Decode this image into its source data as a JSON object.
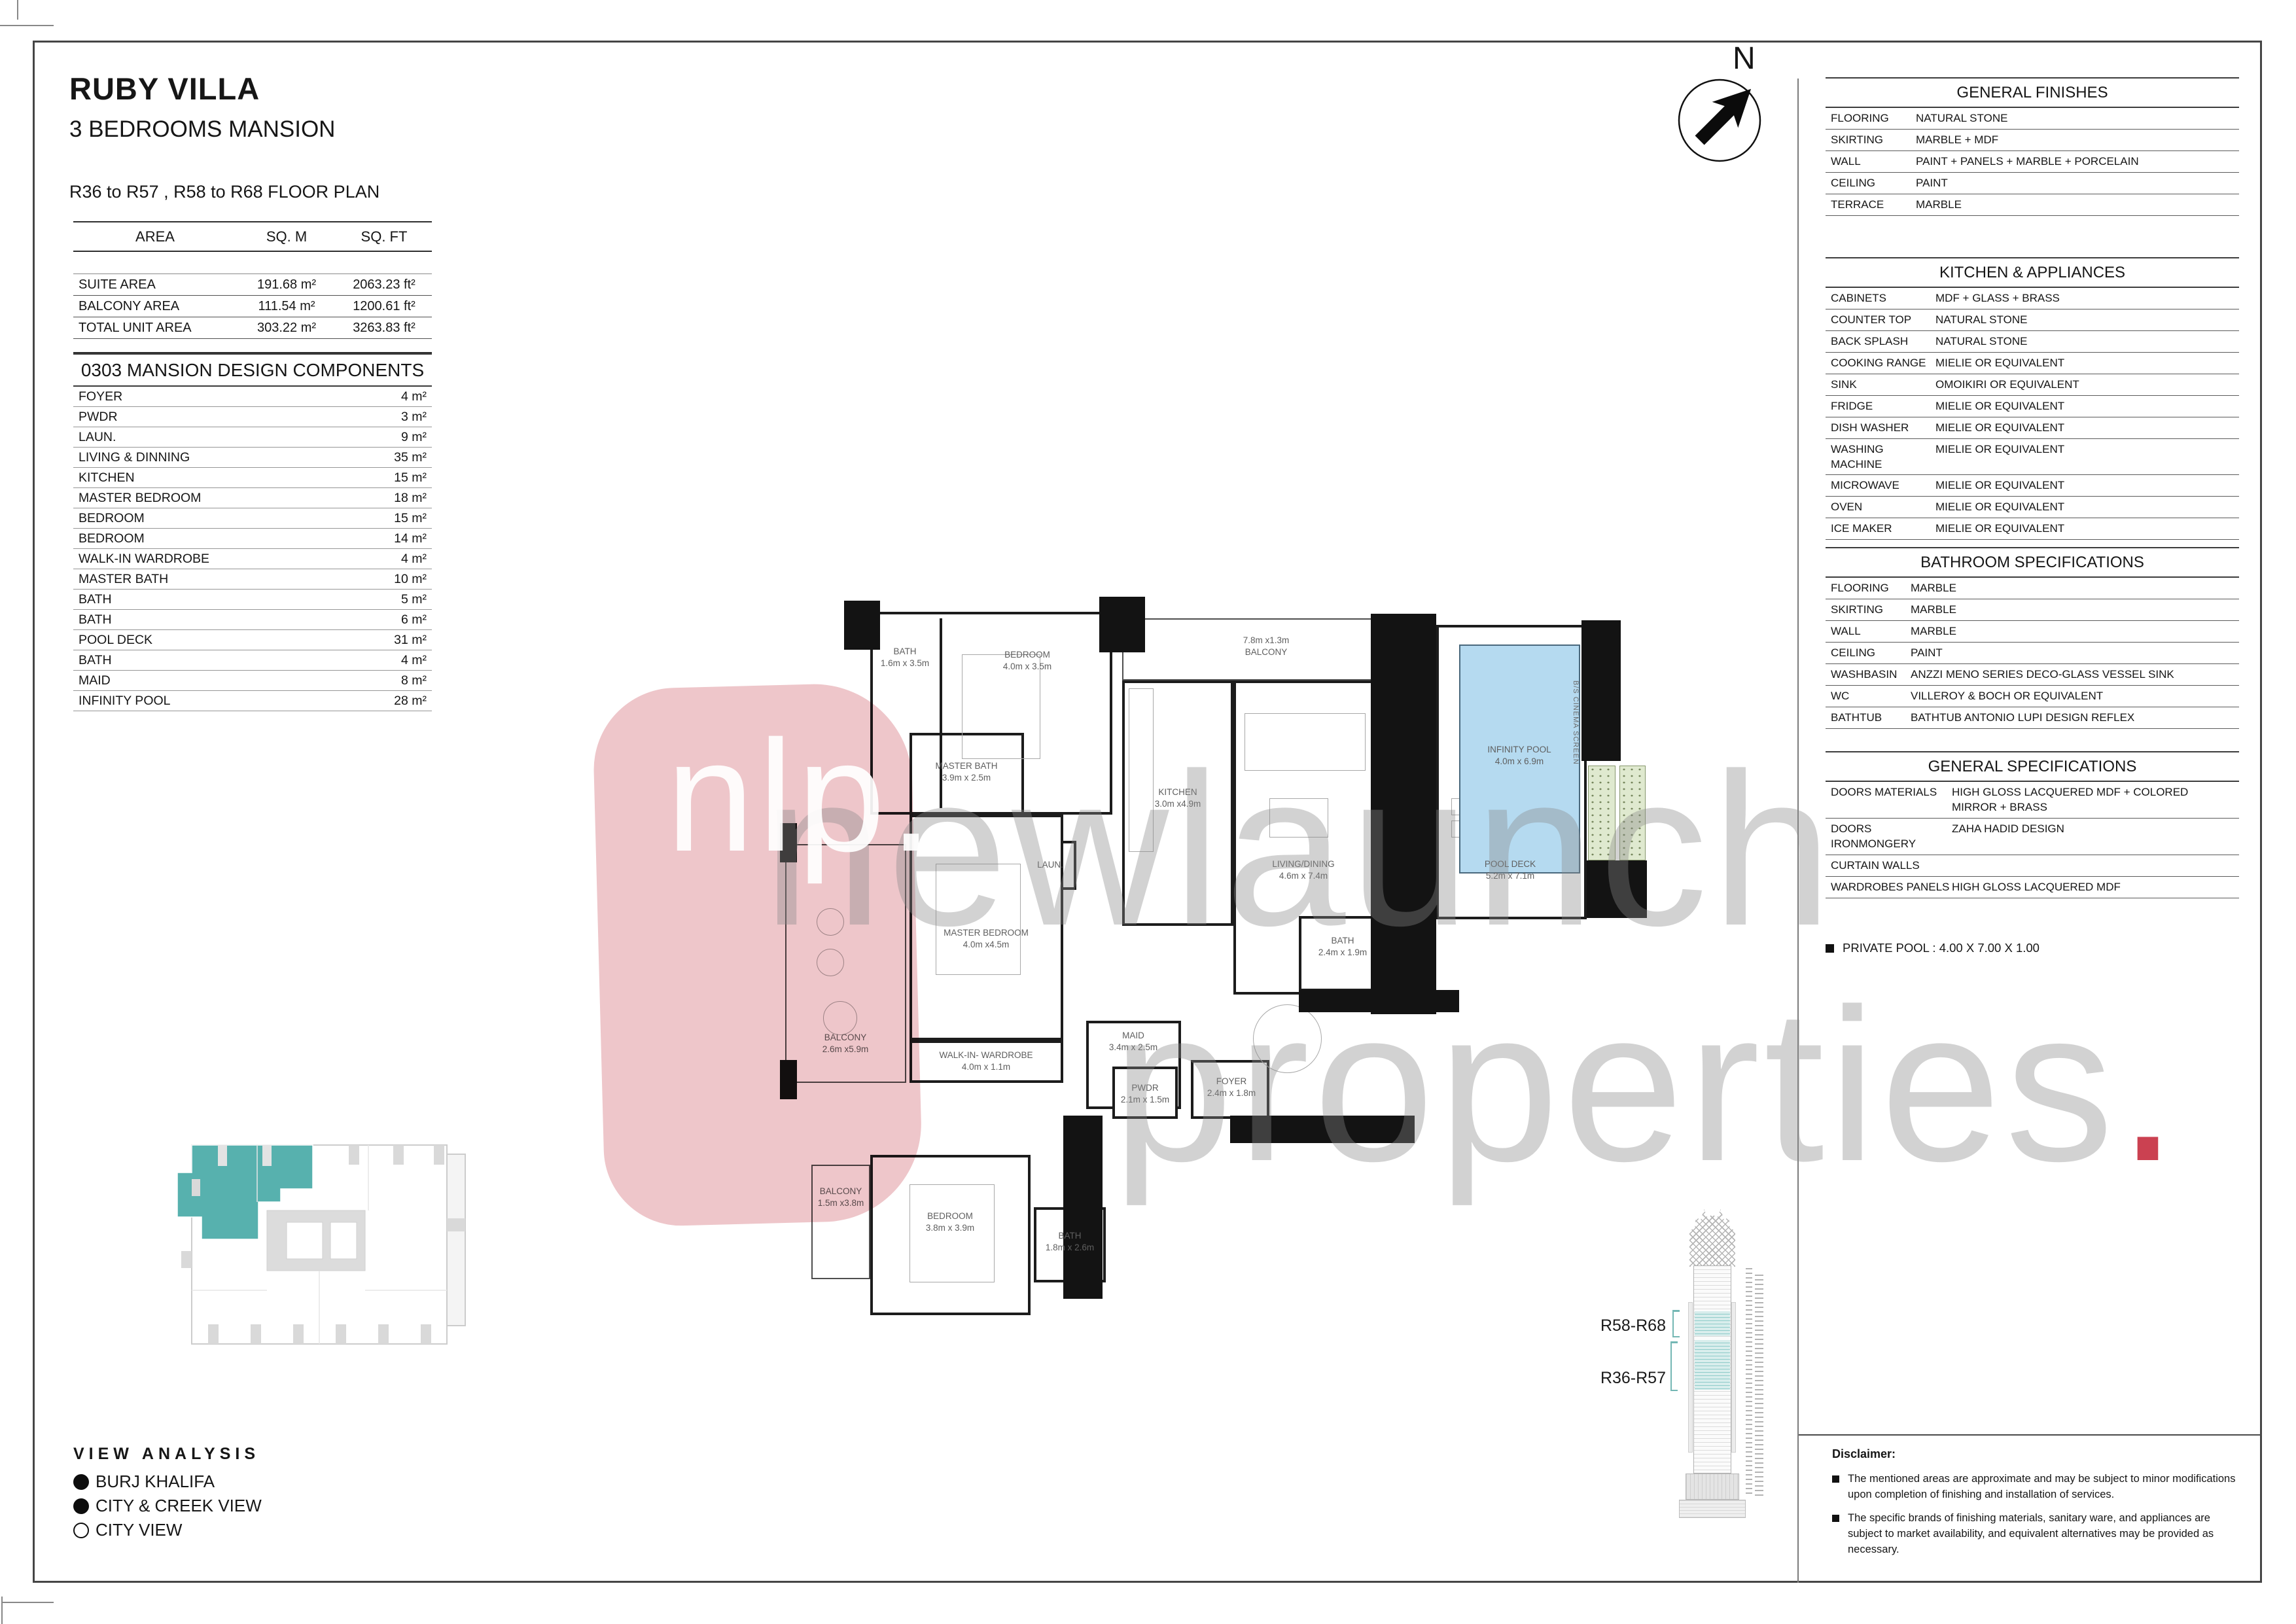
{
  "header": {
    "title": "RUBY VILLA",
    "subtitle": "3 BEDROOMS MANSION",
    "floor_line": "R36 to R57 , R58 to R68 FLOOR PLAN"
  },
  "compass": {
    "label": "N",
    "icon": "north-arrow-icon"
  },
  "area_table": {
    "headers": [
      "AREA",
      "SQ. M",
      "SQ. FT"
    ],
    "rows": [
      [
        "SUITE AREA",
        "191.68 m²",
        "2063.23 ft²"
      ],
      [
        "BALCONY AREA",
        "111.54 m²",
        "1200.61 ft²"
      ],
      [
        "TOTAL UNIT AREA",
        "303.22 m²",
        "3263.83 ft²"
      ]
    ]
  },
  "components": {
    "title": "0303 MANSION DESIGN COMPONENTS",
    "rows": [
      [
        "FOYER",
        "4 m²"
      ],
      [
        "PWDR",
        "3 m²"
      ],
      [
        "LAUN.",
        "9 m²"
      ],
      [
        "LIVING & DINNING",
        "35 m²"
      ],
      [
        "KITCHEN",
        "15 m²"
      ],
      [
        "MASTER BEDROOM",
        "18 m²"
      ],
      [
        "BEDROOM",
        "15 m²"
      ],
      [
        "BEDROOM",
        "14 m²"
      ],
      [
        "WALK-IN WARDROBE",
        "4 m²"
      ],
      [
        "MASTER BATH",
        "10 m²"
      ],
      [
        "BATH",
        "5 m²"
      ],
      [
        "BATH",
        "6 m²"
      ],
      [
        "POOL DECK",
        "31 m²"
      ],
      [
        "BATH",
        "4 m²"
      ],
      [
        "MAID",
        "8 m²"
      ],
      [
        "INFINITY POOL",
        "28 m²"
      ]
    ]
  },
  "specs": {
    "general_finishes": {
      "title": "GENERAL FINISHES",
      "rows": [
        [
          "FLOORING",
          "NATURAL STONE"
        ],
        [
          "SKIRTING",
          "MARBLE + MDF"
        ],
        [
          "WALL",
          "PAINT + PANELS + MARBLE + PORCELAIN"
        ],
        [
          "CEILING",
          "PAINT"
        ],
        [
          "TERRACE",
          "MARBLE"
        ]
      ]
    },
    "kitchen": {
      "title": "KITCHEN & APPLIANCES",
      "rows": [
        [
          "CABINETS",
          "MDF + GLASS + BRASS"
        ],
        [
          "COUNTER TOP",
          "NATURAL STONE"
        ],
        [
          "BACK SPLASH",
          "NATURAL STONE"
        ],
        [
          "COOKING RANGE",
          "MIELIE OR EQUIVALENT"
        ],
        [
          "SINK",
          "OMOIKIRI OR EQUIVALENT"
        ],
        [
          "FRIDGE",
          "MIELIE OR EQUIVALENT"
        ],
        [
          "DISH WASHER",
          "MIELIE OR EQUIVALENT"
        ],
        [
          "WASHING MACHINE",
          "MIELIE OR EQUIVALENT"
        ],
        [
          "MICROWAVE",
          "MIELIE OR EQUIVALENT"
        ],
        [
          "OVEN",
          "MIELIE OR EQUIVALENT"
        ],
        [
          "ICE MAKER",
          "MIELIE OR EQUIVALENT"
        ]
      ]
    },
    "bathroom": {
      "title": "BATHROOM SPECIFICATIONS",
      "rows": [
        [
          "FLOORING",
          "MARBLE"
        ],
        [
          "SKIRTING",
          "MARBLE"
        ],
        [
          "WALL",
          "MARBLE"
        ],
        [
          "CEILING",
          "PAINT"
        ],
        [
          "WASHBASIN",
          "ANZZI  MENO SERIES DECO-GLASS VESSEL SINK"
        ],
        [
          "WC",
          "VILLEROY & BOCH OR EQUIVALENT"
        ],
        [
          "BATHTUB",
          "BATHTUB ANTONIO LUPI DESIGN REFLEX"
        ]
      ]
    },
    "general_specs": {
      "title": "GENERAL SPECIFICATIONS",
      "rows": [
        [
          "DOORS MATERIALS",
          "HIGH GLOSS LACQUERED MDF + COLORED MIRROR + BRASS"
        ],
        [
          "DOORS IRONMONGERY",
          "ZAHA HADID DESIGN"
        ],
        [
          "CURTAIN WALLS",
          ""
        ],
        [
          "WARDROBES PANELS",
          "HIGH GLOSS LACQUERED MDF"
        ]
      ]
    }
  },
  "private_pool_note": "PRIVATE POOL :  4.00 X 7.00 X 1.00",
  "disclaimer": {
    "title": "Disclaimer:",
    "items": [
      "The mentioned areas are approximate and may be subject to minor modifications  upon completion of finishing and installation of services.",
      "The specific brands of finishing materials, sanitary ware, and appliances are subject to market availability, and equivalent alternatives may be provided as necessary."
    ]
  },
  "view_analysis": {
    "title": "VIEW ANALYSIS",
    "items": [
      {
        "label": "BURJ KHALIFA",
        "filled": true
      },
      {
        "label": "CITY & CREEK VIEW",
        "filled": true
      },
      {
        "label": "CITY VIEW",
        "filled": false
      }
    ]
  },
  "tower": {
    "upper_label": "R58-R68",
    "lower_label": "R36-R57"
  },
  "watermark": {
    "logo": "nlp.",
    "line1": "newlaunch",
    "line2": "properties",
    "dot": ".",
    "accent_color": "#c22033",
    "pink_color": "#eec6ca"
  },
  "plan": {
    "rooms": {
      "bath_top": {
        "name": "BATH",
        "dims": "1.6m x 3.5m"
      },
      "bedroom_top": {
        "name": "BEDROOM",
        "dims": "4.0m x 3.5m"
      },
      "balcony_top": {
        "name": "BALCONY",
        "dims": "7.8m x1.3m"
      },
      "kitchen": {
        "name": "KITCHEN",
        "dims": "3.0m x4.9m"
      },
      "living": {
        "name": "LIVING/DINING",
        "dims": "4.6m x 7.4m"
      },
      "pool_deck": {
        "name": "POOL DECK",
        "dims": "5.2m x 7.1m"
      },
      "infinity_pool": {
        "name": "INFINITY POOL",
        "dims": "4.0m x 6.9m"
      },
      "cinema_screen": {
        "name": "B/S CINEMA SCREEN"
      },
      "master_bath": {
        "name": "MASTER BATH",
        "dims": "3.9m x 2.5m"
      },
      "laundry": {
        "name": "LAUN."
      },
      "balcony_left": {
        "name": "BALCONY",
        "dims": "2.6m x5.9m"
      },
      "master_bedroom": {
        "name": "MASTER BEDROOM",
        "dims": "4.0m x4.5m"
      },
      "maid": {
        "name": "MAID",
        "dims": "3.4m x 2.5m"
      },
      "pwdr": {
        "name": "PWDR",
        "dims": "2.1m x 1.5m"
      },
      "foyer": {
        "name": "FOYER",
        "dims": "2.4m x 1.8m"
      },
      "bath_pool": {
        "name": "BATH",
        "dims": "2.4m x 1.9m"
      },
      "wardrobe": {
        "name": "WALK-IN- WARDROBE",
        "dims": "4.0m x 1.1m"
      },
      "balcony_bottom": {
        "name": "BALCONY",
        "dims": "1.5m x3.8m"
      },
      "bedroom_bottom": {
        "name": "BEDROOM",
        "dims": "3.8m x 3.9m"
      },
      "bath_bottom": {
        "name": "BATH",
        "dims": "1.8m x 2.6m"
      }
    }
  }
}
